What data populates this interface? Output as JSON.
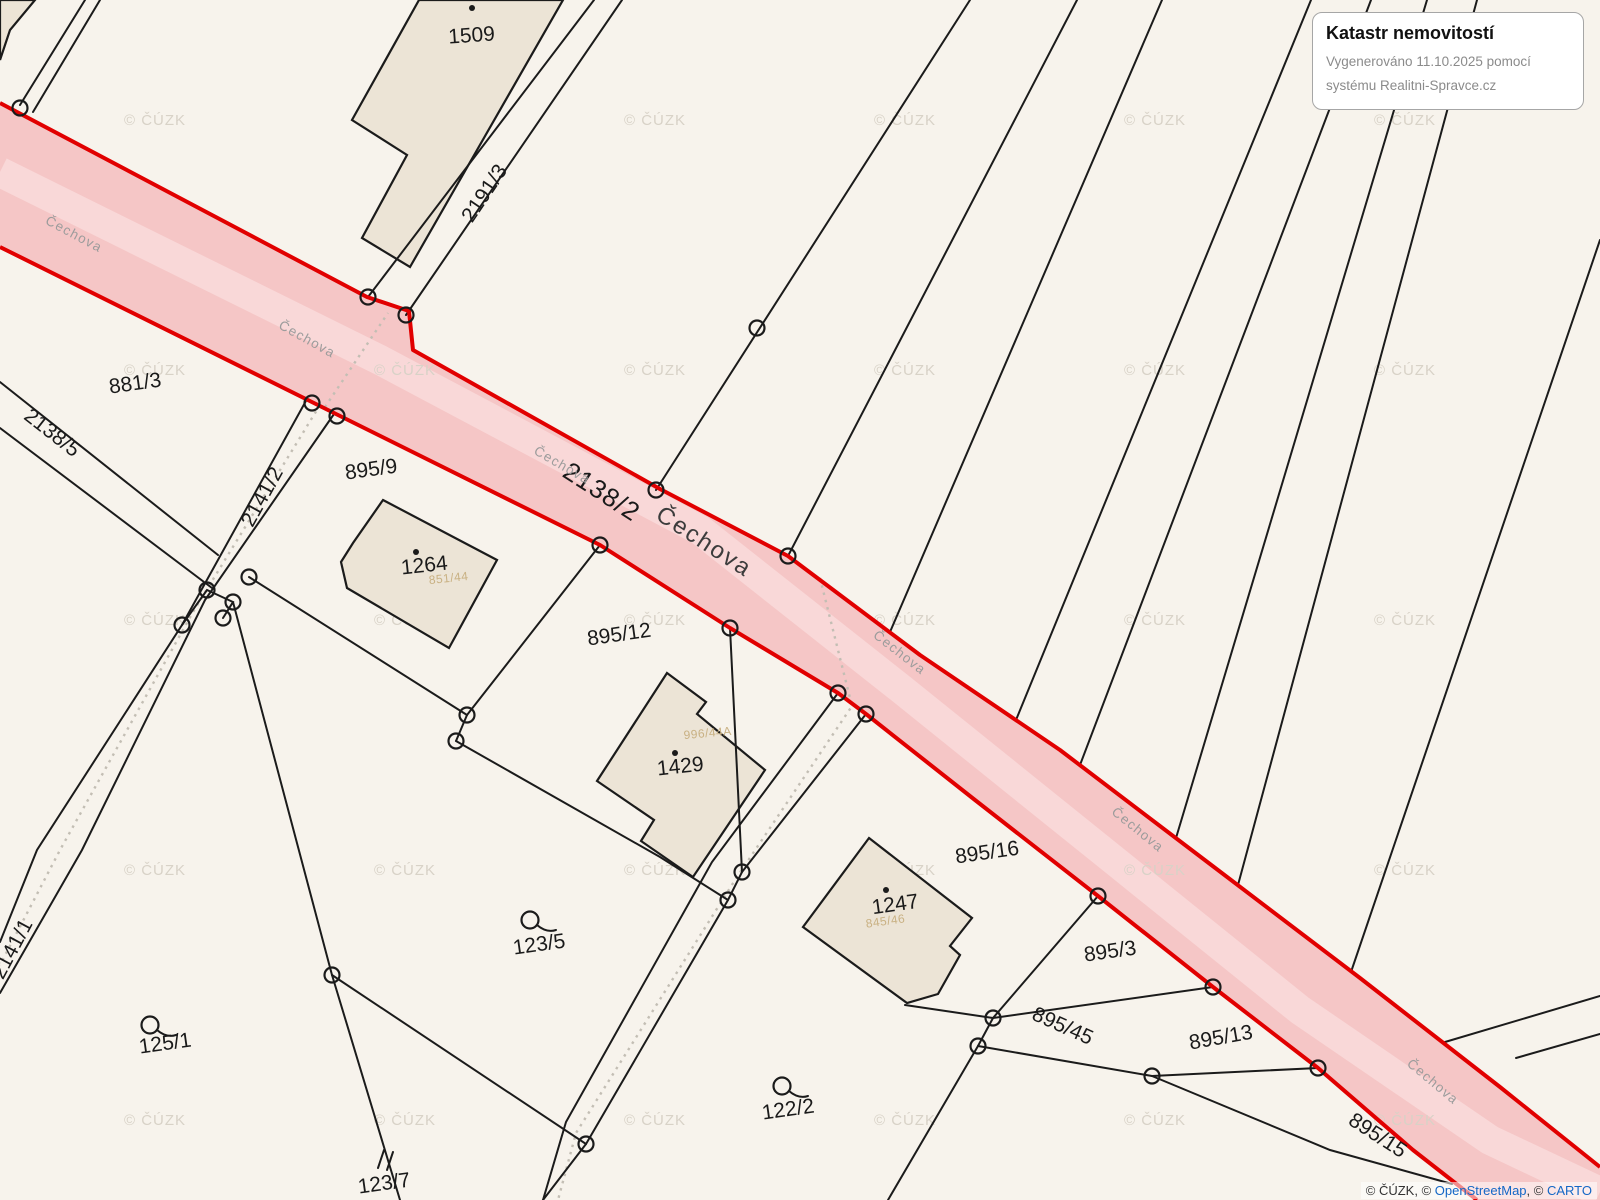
{
  "info_box": {
    "title": "Katastr nemovitostí",
    "line1": "Vygenerováno 11.10.2025 pomocí",
    "line2": "systému Realitni-Spravce.cz"
  },
  "attribution": {
    "czuk": "© ČÚZK, © ",
    "osm": "OpenStreetMap",
    "sep": ", © ",
    "carto": "CARTO"
  },
  "watermark": {
    "text": "© ČÚZK"
  },
  "street": {
    "name": "Čechova"
  },
  "road": {
    "parcel_number": "2138/2",
    "street_name": "Čechova"
  },
  "parcels": [
    "2191/3",
    "881/3",
    "2138/5",
    "2141/2",
    "895/9",
    "895/12",
    "895/16",
    "895/3",
    "895/45",
    "895/13",
    "895/15",
    "125/1",
    "123/5",
    "122/2",
    "123/7",
    "2141/1"
  ],
  "buildings": [
    "1509",
    "1264",
    "1429",
    "1247"
  ],
  "landuse": [
    "851/44",
    "996/44A",
    "845/46"
  ],
  "colors": {
    "background": "#f7f3ec",
    "road_fill": "#f5c6c6",
    "road_stripe": "#f9d8d8",
    "road_border": "#e10000",
    "building_fill": "#ece4d6",
    "line": "#1b1b1b",
    "wat_grey": "#d8d2c7",
    "street_label": "#9c9c9c",
    "landuse_label": "#c9b183",
    "link_blue": "#1467c6"
  }
}
